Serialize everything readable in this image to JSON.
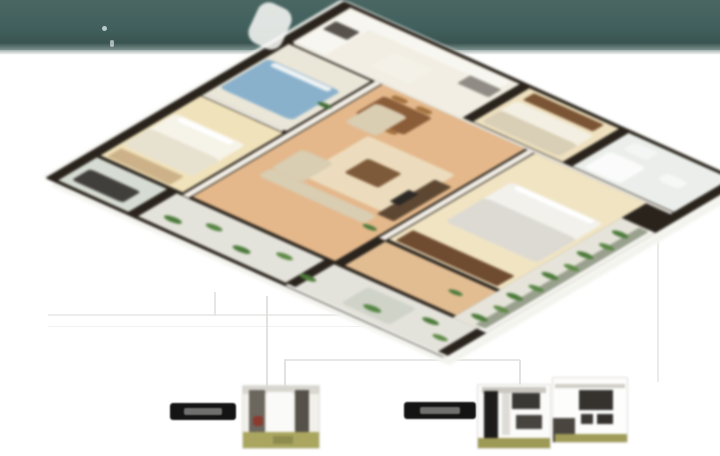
{
  "page": {
    "width": 720,
    "height": 456,
    "background": "#ffffff"
  },
  "header_band": {
    "color_top": "#4a6663",
    "color_mid": "#41605d",
    "color_bottom": "#3a5451",
    "edge_highlight": "#a3b2ae",
    "height": 50,
    "specks": [
      {
        "id": "speck",
        "b": [
          102,
          26,
          5,
          5
        ],
        "c": "rgba(240,248,246,0.7)",
        "r": 3
      },
      {
        "id": "speck",
        "b": [
          110,
          40,
          4,
          7
        ],
        "c": "rgba(240,248,246,0.6)",
        "r": 3
      }
    ]
  },
  "floor_plan": {
    "description": "3D isometric cutaway render of an apartment floor plan",
    "wall_color": "#29231c",
    "slab_color": "#f4f4ef",
    "rooms": [
      {
        "id": "room-utility-corner",
        "b": [
          8,
          8,
          88,
          58
        ],
        "c": "#d6dcd3"
      },
      {
        "id": "room-balcony-left",
        "b": [
          8,
          74,
          88,
          122
        ],
        "c": "#e4e3db"
      },
      {
        "id": "room-balcony-corner",
        "b": [
          8,
          204,
          88,
          118
        ],
        "c": "#e4e3db"
      },
      {
        "id": "room-bedroom-cream",
        "b": [
          104,
          8,
          228,
          68
        ],
        "c": "#f0e2ba"
      },
      {
        "id": "room-bedroom-blue",
        "b": [
          340,
          8,
          192,
          68
        ],
        "c": "#eae6d8"
      },
      {
        "id": "room-kitchen",
        "b": [
          540,
          8,
          132,
          140
        ],
        "c": "#f2eee3"
      },
      {
        "id": "room-living-dining",
        "b": [
          104,
          84,
          432,
          118
        ],
        "c": "#e4b88b"
      },
      {
        "id": "room-hall-lower",
        "b": [
          104,
          210,
          92,
          92
        ],
        "c": "#e2bd92"
      },
      {
        "id": "room-master-bedroom",
        "b": [
          204,
          210,
          332,
          92
        ],
        "c": "#f1e4c2"
      },
      {
        "id": "room-bedroom-right",
        "b": [
          544,
          156,
          128,
          74
        ],
        "c": "#efe1bf"
      },
      {
        "id": "room-bath-right",
        "b": [
          544,
          238,
          128,
          84
        ],
        "c": "#ebeeea"
      },
      {
        "id": "room-balcony-bottom",
        "b": [
          96,
          302,
          384,
          28
        ],
        "c": "#e6e4da"
      }
    ],
    "wall_caps": [
      {
        "id": "wall-cap",
        "b": [
          98,
          78,
          438,
          5
        ],
        "c": "#f3efe6"
      },
      {
        "id": "wall-cap",
        "b": [
          536,
          10,
          6,
          312
        ],
        "c": "#edeae1"
      },
      {
        "id": "wall-cap",
        "b": [
          198,
          204,
          338,
          5
        ],
        "c": "#f1ede4"
      },
      {
        "id": "wall-cap",
        "b": [
          334,
          8,
          6,
          66
        ],
        "c": "#efece4"
      },
      {
        "id": "railing",
        "b": [
          96,
          324,
          384,
          5
        ],
        "c": "#f6f6f2"
      },
      {
        "id": "railing",
        "b": [
          2,
          198,
          6,
          132
        ],
        "c": "#f6f6f2"
      }
    ],
    "furniture": [
      {
        "id": "washing-machine",
        "b": [
          22,
          14,
          42,
          42
        ],
        "c": "#413f3b",
        "r": 4
      },
      {
        "id": "bed-cream",
        "b": [
          148,
          10,
          122,
          58
        ],
        "c": "#f6f3e8",
        "r": 6
      },
      {
        "id": "bed-cream-blanket",
        "b": [
          148,
          10,
          64,
          58
        ],
        "c": "#e7e1cf",
        "r": 6
      },
      {
        "id": "bed-cream-pillows",
        "b": [
          254,
          16,
          12,
          44
        ],
        "c": "#ffffff",
        "r": 3
      },
      {
        "id": "wardrobe-cream-room",
        "b": [
          108,
          12,
          32,
          52
        ],
        "c": "#cdb289",
        "r": 2
      },
      {
        "id": "bed-blue",
        "b": [
          368,
          10,
          112,
          60
        ],
        "c": "#8ab1cc",
        "r": 6
      },
      {
        "id": "bed-blue-pillows",
        "b": [
          466,
          16,
          12,
          48
        ],
        "c": "#eef3f5",
        "r": 3
      },
      {
        "id": "kitchen-counter-top",
        "b": [
          544,
          10,
          122,
          24
        ],
        "c": "#f7f6f0",
        "r": 2
      },
      {
        "id": "kitchen-counter-side",
        "b": [
          642,
          10,
          26,
          132
        ],
        "c": "#f7f6f0",
        "r": 2
      },
      {
        "id": "kitchen-range",
        "b": [
          598,
          12,
          30,
          20
        ],
        "c": "#57524b",
        "r": 2
      },
      {
        "id": "kitchen-island",
        "b": [
          564,
          64,
          54,
          32
        ],
        "c": "#f3f1e8",
        "r": 2
      },
      {
        "id": "kitchen-fridge",
        "b": [
          612,
          118,
          30,
          26
        ],
        "c": "#908c85",
        "r": 2
      },
      {
        "id": "dining-table",
        "b": [
          446,
          94,
          66,
          40
        ],
        "c": "#8a5c38",
        "r": 4
      },
      {
        "id": "dining-chair",
        "b": [
          436,
          98,
          12,
          12
        ],
        "c": "#a2713f",
        "r": 4
      },
      {
        "id": "dining-chair",
        "b": [
          436,
          118,
          12,
          12
        ],
        "c": "#a2713f",
        "r": 4
      },
      {
        "id": "dining-chair",
        "b": [
          514,
          98,
          12,
          12
        ],
        "c": "#a2713f",
        "r": 4
      },
      {
        "id": "dining-chair",
        "b": [
          514,
          118,
          12,
          12
        ],
        "c": "#a2713f",
        "r": 4
      },
      {
        "id": "living-rug",
        "b": [
          258,
          118,
          152,
          72
        ],
        "c": "#ecdcbd",
        "r": 4
      },
      {
        "id": "sofa-l-long",
        "b": [
          214,
          98,
          30,
          88
        ],
        "c": "#d9cdb2",
        "r": 6
      },
      {
        "id": "sofa-l-short",
        "b": [
          244,
          98,
          72,
          26
        ],
        "c": "#d9cdb2",
        "r": 6
      },
      {
        "id": "loveseat",
        "b": [
          416,
          96,
          74,
          26
        ],
        "c": "#d9cdb2",
        "r": 6
      },
      {
        "id": "coffee-table",
        "b": [
          306,
          136,
          54,
          28
        ],
        "c": "#7d5a39",
        "r": 3
      },
      {
        "id": "tv-console",
        "b": [
          248,
          184,
          132,
          14
        ],
        "c": "#5d4732",
        "r": 2
      },
      {
        "id": "tv",
        "b": [
          288,
          180,
          44,
          8
        ],
        "c": "#2c2824",
        "r": 1
      },
      {
        "id": "wardrobe-master",
        "b": [
          208,
          214,
          40,
          84
        ],
        "c": "#6f4b30",
        "r": 2
      },
      {
        "id": "master-bed",
        "b": [
          298,
          222,
          152,
          76
        ],
        "c": "#f2f1ec",
        "r": 6
      },
      {
        "id": "master-duvet",
        "b": [
          298,
          222,
          92,
          76
        ],
        "c": "#dcdad2",
        "r": 6
      },
      {
        "id": "master-pillows",
        "b": [
          436,
          228,
          12,
          64
        ],
        "c": "#ffffff",
        "r": 3
      },
      {
        "id": "bed-right",
        "b": [
          552,
          160,
          80,
          64
        ],
        "c": "#f3efe2",
        "r": 5
      },
      {
        "id": "bed-right-blanket",
        "b": [
          552,
          160,
          44,
          64
        ],
        "c": "#d9cfb6",
        "r": 5
      },
      {
        "id": "dresser-right",
        "b": [
          640,
          162,
          26,
          58
        ],
        "c": "#7a5434",
        "r": 2
      },
      {
        "id": "bathtub",
        "b": [
          552,
          244,
          62,
          30
        ],
        "c": "#fafbfa",
        "r": 6
      },
      {
        "id": "bath-sink",
        "b": [
          630,
          248,
          28,
          20
        ],
        "c": "#f4f6f5",
        "r": 4
      },
      {
        "id": "toilet",
        "b": [
          598,
          288,
          24,
          18
        ],
        "c": "#f6f8f7",
        "r": 6
      },
      {
        "id": "balcony-planter-strip",
        "b": [
          104,
          318,
          372,
          8
        ],
        "c": "#99a08d",
        "r": 2
      },
      {
        "id": "balcony-lounge",
        "b": [
          18,
          238,
          62,
          40
        ],
        "c": "#cfd3c8",
        "r": 4
      }
    ],
    "plants": [
      {
        "id": "plant",
        "b": [
          28,
          86,
          14,
          14
        ],
        "c": "#4c7a3a",
        "r": 7
      },
      {
        "id": "plant",
        "b": [
          52,
          112,
          13,
          13
        ],
        "c": "#578544",
        "r": 7
      },
      {
        "id": "plant",
        "b": [
          30,
          142,
          14,
          14
        ],
        "c": "#4c7a3a",
        "r": 7
      },
      {
        "id": "plant",
        "b": [
          58,
          168,
          13,
          13
        ],
        "c": "#5e8a46",
        "r": 7
      },
      {
        "id": "plant",
        "b": [
          34,
          196,
          13,
          13
        ],
        "c": "#4c7a3a",
        "r": 7
      },
      {
        "id": "plant",
        "b": [
          30,
          250,
          14,
          14
        ],
        "c": "#578544",
        "r": 7
      },
      {
        "id": "plant",
        "b": [
          60,
          288,
          13,
          13
        ],
        "c": "#4c7a3a",
        "r": 7
      },
      {
        "id": "plant",
        "b": [
          34,
          306,
          12,
          12
        ],
        "c": "#5e8a46",
        "r": 7
      },
      {
        "id": "plant",
        "b": [
          116,
          308,
          13,
          13
        ],
        "c": "#4c7a3a",
        "r": 7
      },
      {
        "id": "plant",
        "b": [
          156,
          312,
          12,
          12
        ],
        "c": "#5e8a46",
        "r": 7
      },
      {
        "id": "plant",
        "b": [
          196,
          308,
          13,
          13
        ],
        "c": "#4c7a3a",
        "r": 7
      },
      {
        "id": "plant",
        "b": [
          236,
          312,
          12,
          12
        ],
        "c": "#578544",
        "r": 7
      },
      {
        "id": "plant",
        "b": [
          276,
          308,
          13,
          13
        ],
        "c": "#4c7a3a",
        "r": 7
      },
      {
        "id": "plant",
        "b": [
          316,
          312,
          12,
          12
        ],
        "c": "#5e8a46",
        "r": 7
      },
      {
        "id": "plant",
        "b": [
          356,
          308,
          13,
          13
        ],
        "c": "#4c7a3a",
        "r": 7
      },
      {
        "id": "plant",
        "b": [
          396,
          312,
          12,
          12
        ],
        "c": "#578544",
        "r": 7
      },
      {
        "id": "plant",
        "b": [
          436,
          308,
          13,
          13
        ],
        "c": "#4c7a3a",
        "r": 7
      },
      {
        "id": "plant",
        "b": [
          206,
          186,
          11,
          11
        ],
        "c": "#4c7a3a",
        "r": 6
      },
      {
        "id": "plant",
        "b": [
          428,
          68,
          11,
          11
        ],
        "c": "#3f6b32",
        "r": 6
      },
      {
        "id": "plant",
        "b": [
          148,
          278,
          11,
          11
        ],
        "c": "#4c7a3a",
        "r": 6
      }
    ]
  },
  "misc": {
    "shapes": [
      {
        "id": "white-roof-piece",
        "b": [
          252,
          4,
          36,
          44
        ],
        "c": "#fbfbf9",
        "r": 12,
        "o": 0.85,
        "rot": 25
      }
    ]
  },
  "callouts": {
    "lines": [
      {
        "id": "leader-line-h",
        "b": [
          48,
          314,
          382,
          2
        ],
        "c": "#ececeb"
      },
      {
        "id": "leader-line-h",
        "b": [
          48,
          326,
          374,
          1
        ],
        "c": "#f1f1f0"
      },
      {
        "id": "leader-line-v",
        "b": [
          214,
          292,
          2,
          24
        ],
        "c": "#e6e6e5"
      },
      {
        "id": "leader-line-v",
        "b": [
          266,
          296,
          2,
          104
        ],
        "c": "#e2e2e1"
      },
      {
        "id": "leader-line-h",
        "b": [
          284,
          359,
          236,
          2
        ],
        "c": "#e6e6e5"
      },
      {
        "id": "leader-line-v",
        "b": [
          284,
          360,
          2,
          44
        ],
        "c": "#e2e2e1"
      },
      {
        "id": "leader-line-v",
        "b": [
          519,
          360,
          2,
          28
        ],
        "c": "#e2e2e1"
      },
      {
        "id": "leader-line-v",
        "b": [
          657,
          240,
          2,
          142
        ],
        "c": "#ebebea"
      }
    ],
    "labels": [
      {
        "id": "callout-label-left",
        "text": "",
        "bg": "#141414",
        "shapes": [
          {
            "id": "label-text-smudge",
            "b": [
              14,
              5,
              38,
              7
            ],
            "c": "rgba(225,225,222,0.45)",
            "r": 2
          }
        ]
      },
      {
        "id": "callout-label-right",
        "text": "",
        "bg": "#141414",
        "shapes": [
          {
            "id": "label-text-smudge",
            "b": [
              16,
              5,
              40,
              7
            ],
            "c": "rgba(225,225,222,0.45)",
            "r": 2
          }
        ]
      }
    ],
    "thumbnails": [
      {
        "id": "interior-photo-thumbnail-1",
        "shapes": [
          {
            "id": "photo-roofline",
            "b": [
              0,
              0,
              76,
              8
            ],
            "c": "#d8d6cf"
          },
          {
            "id": "photo-dark-wall-left",
            "b": [
              6,
              4,
              16,
              52
            ],
            "c": "#6b665e"
          },
          {
            "id": "photo-bright-window",
            "b": [
              24,
              6,
              26,
              46
            ],
            "c": "#fafaf8"
          },
          {
            "id": "photo-dark-pillar",
            "b": [
              52,
              4,
              14,
              44
            ],
            "c": "#55514a"
          },
          {
            "id": "photo-red-accent",
            "b": [
              10,
              30,
              10,
              10
            ],
            "c": "#8b3a2e",
            "r": 3
          },
          {
            "id": "photo-grass-band",
            "b": [
              0,
              46,
              76,
              16
            ],
            "c": "#aaa660"
          },
          {
            "id": "photo-grass-shadow",
            "b": [
              30,
              50,
              20,
              8
            ],
            "c": "#8e8b4e"
          }
        ]
      },
      {
        "id": "interior-photo-thumbnail-2",
        "shapes": [
          {
            "id": "photo-ceiling",
            "b": [
              4,
              2,
              64,
              6
            ],
            "c": "#c9c7c0"
          },
          {
            "id": "photo-black-cabinet",
            "b": [
              6,
              6,
              14,
              50
            ],
            "c": "#1d1c1a"
          },
          {
            "id": "photo-wall-panel",
            "b": [
              24,
              8,
              8,
              42
            ],
            "c": "#dedcd6"
          },
          {
            "id": "photo-dark-unit-top",
            "b": [
              34,
              8,
              28,
              16
            ],
            "c": "#3a3835"
          },
          {
            "id": "photo-dark-unit-bottom",
            "b": [
              38,
              30,
              26,
              14
            ],
            "c": "#474440"
          },
          {
            "id": "photo-floor-band",
            "b": [
              0,
              53,
              72,
              10
            ],
            "c": "#9d9a55"
          }
        ]
      },
      {
        "id": "interior-photo-thumbnail-3",
        "shapes": [
          {
            "id": "photo-ceiling-line",
            "b": [
              2,
              6,
              70,
              4
            ],
            "c": "#cfcdc6"
          },
          {
            "id": "photo-tv-panel",
            "b": [
              26,
              12,
              34,
              20
            ],
            "c": "#35322e"
          },
          {
            "id": "photo-cabinet-left",
            "b": [
              28,
              36,
              12,
              10
            ],
            "c": "#3c3935"
          },
          {
            "id": "photo-cabinet-right",
            "b": [
              44,
              36,
              16,
              10
            ],
            "c": "#34312d"
          },
          {
            "id": "photo-dark-corner",
            "b": [
              0,
              40,
              22,
              24
            ],
            "c": "#4a463f"
          },
          {
            "id": "photo-floor-band",
            "b": [
              2,
              56,
              72,
              8
            ],
            "c": "#a09c58"
          }
        ]
      }
    ]
  }
}
